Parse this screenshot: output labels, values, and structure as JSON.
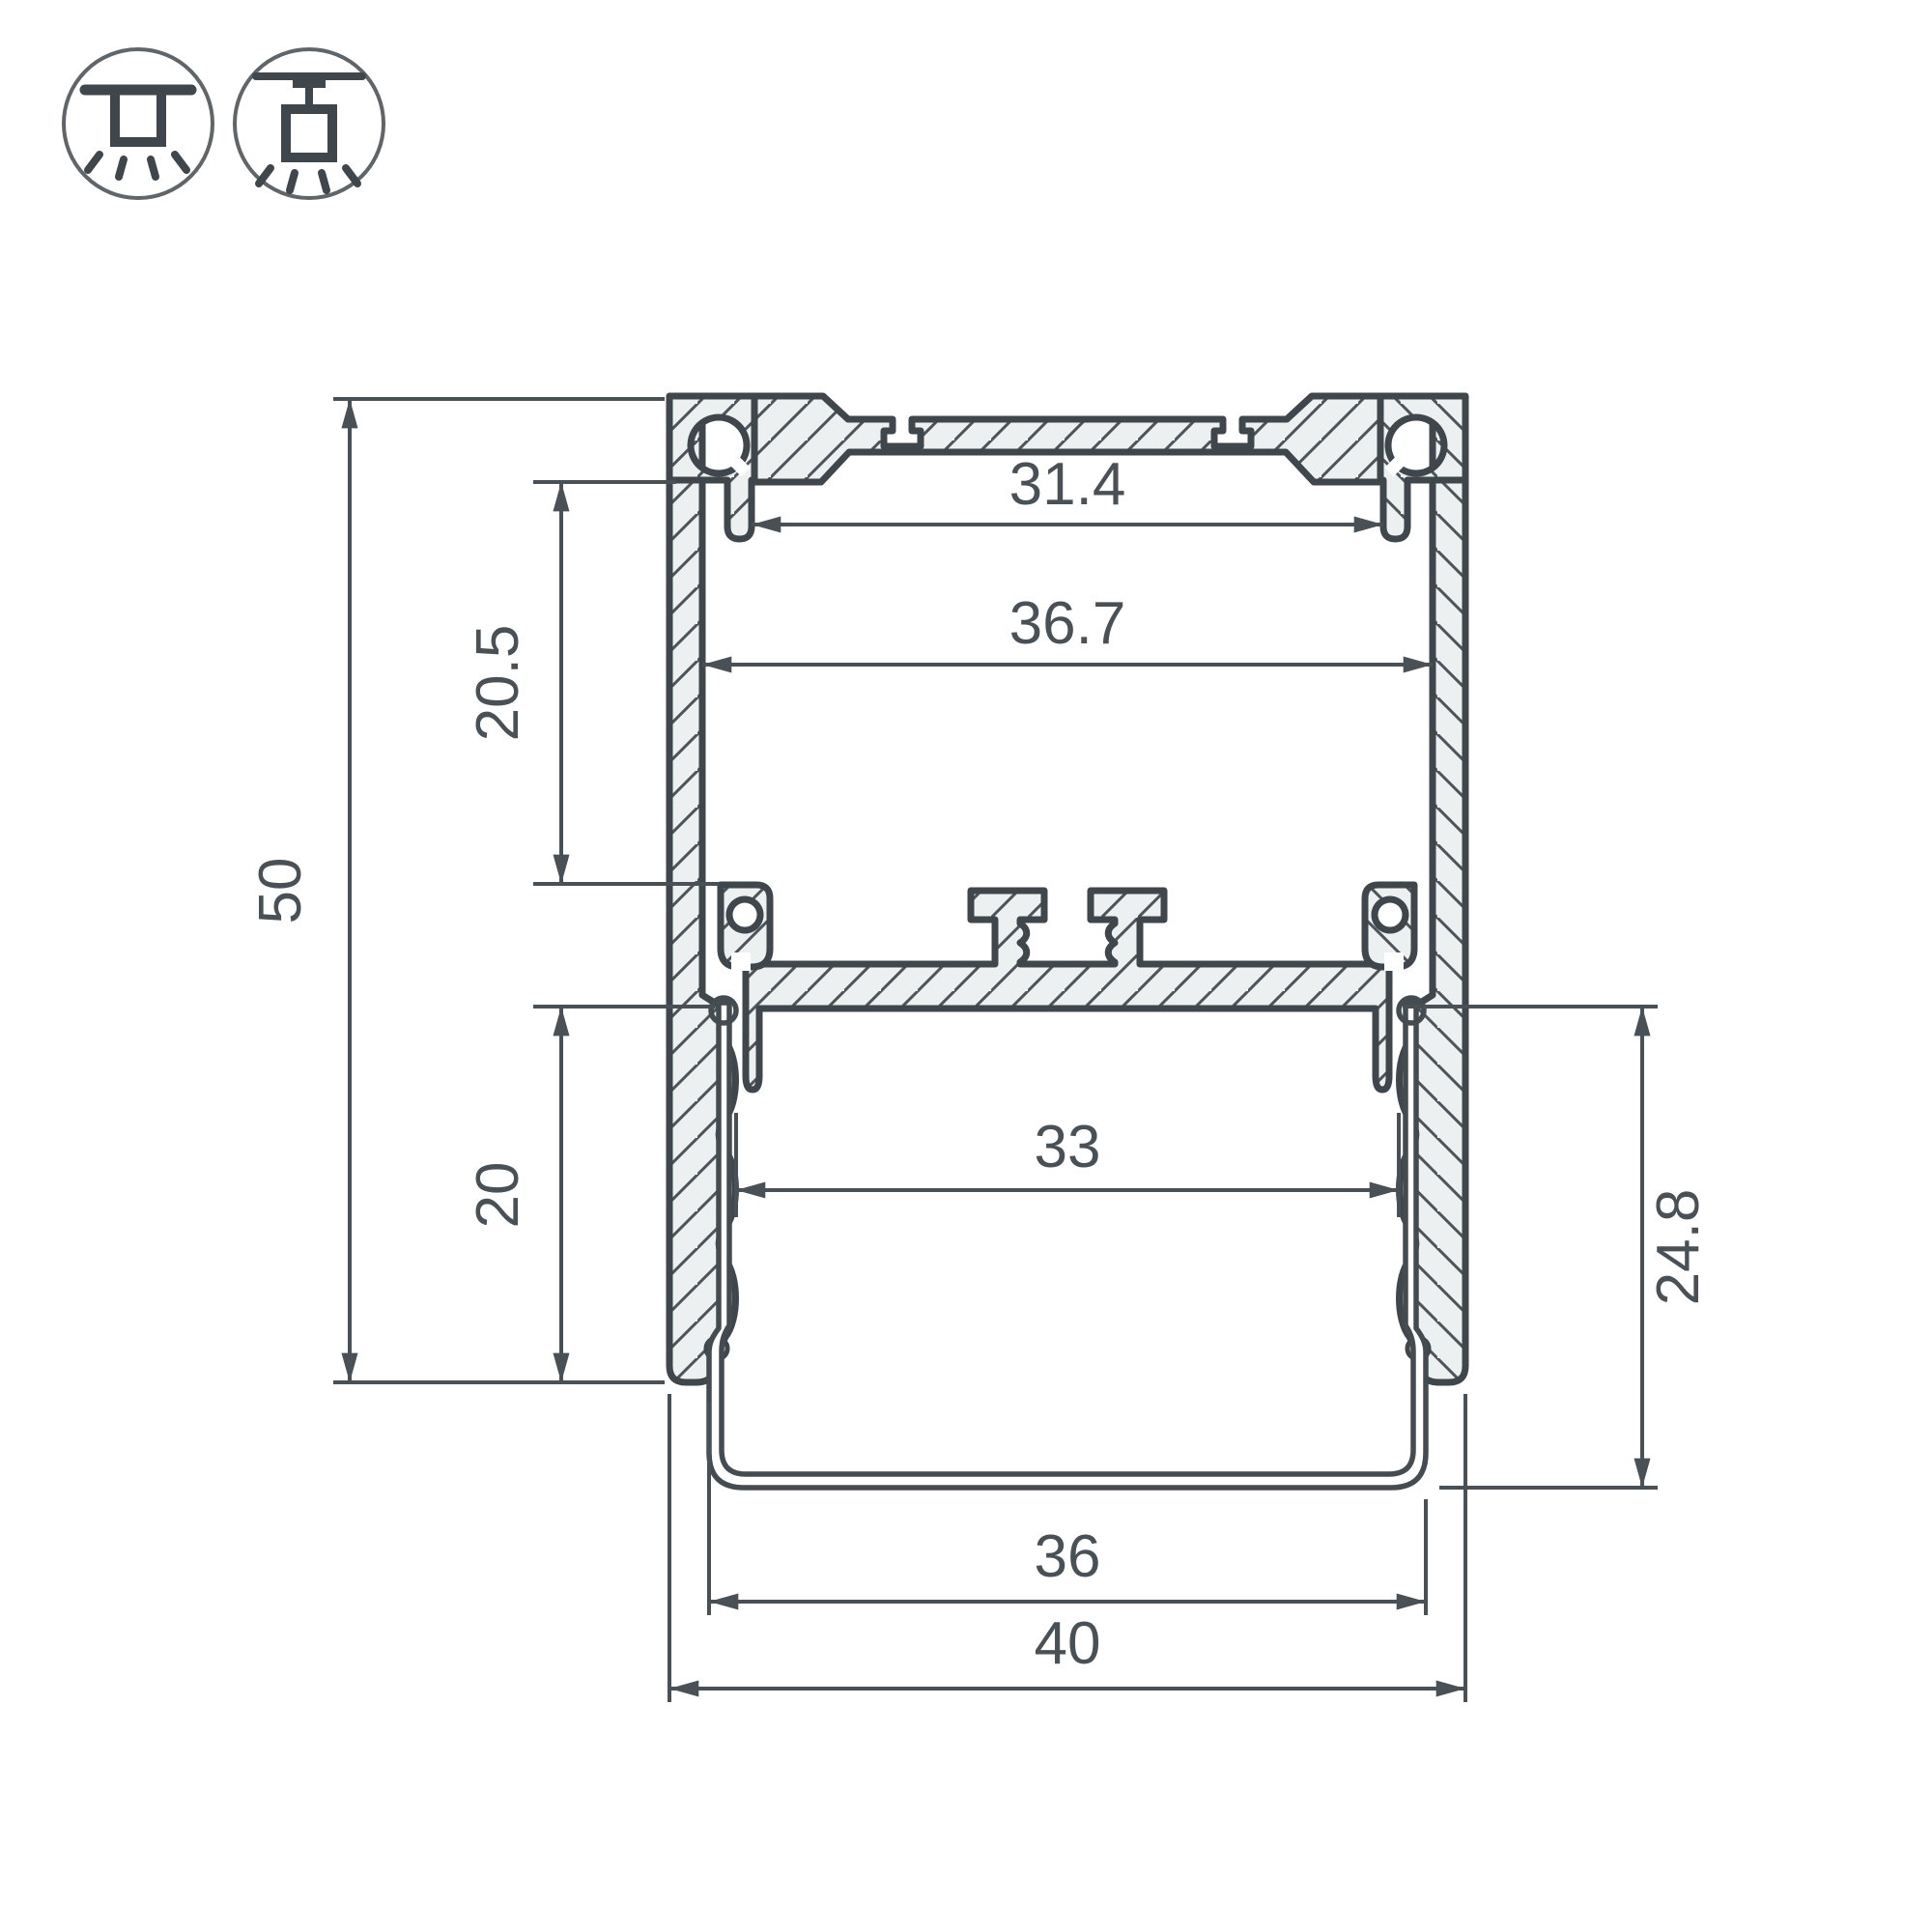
{
  "drawing": {
    "title": "aluminium-led-profile-cross-section",
    "type": "technical-dimension-drawing"
  },
  "icons": {
    "surface_mount": "surface-ceiling-mount",
    "pendant_mount": "pendant-suspension-mount"
  },
  "dims": {
    "total_height": "50",
    "total_width": "40",
    "upper_chamber_height": "20.5",
    "lower_chamber_height": "20",
    "top_opening_width": "31.4",
    "inner_width": "36.7",
    "shelf_width": "33",
    "diffuser_depth": "24.8",
    "diffuser_width": "36"
  },
  "colors": {
    "outline": "#40474c",
    "hatch": "#4e555a",
    "aluminium_fill": "#edf0f1",
    "dimension": "#4a5156",
    "background": "#ffffff"
  }
}
